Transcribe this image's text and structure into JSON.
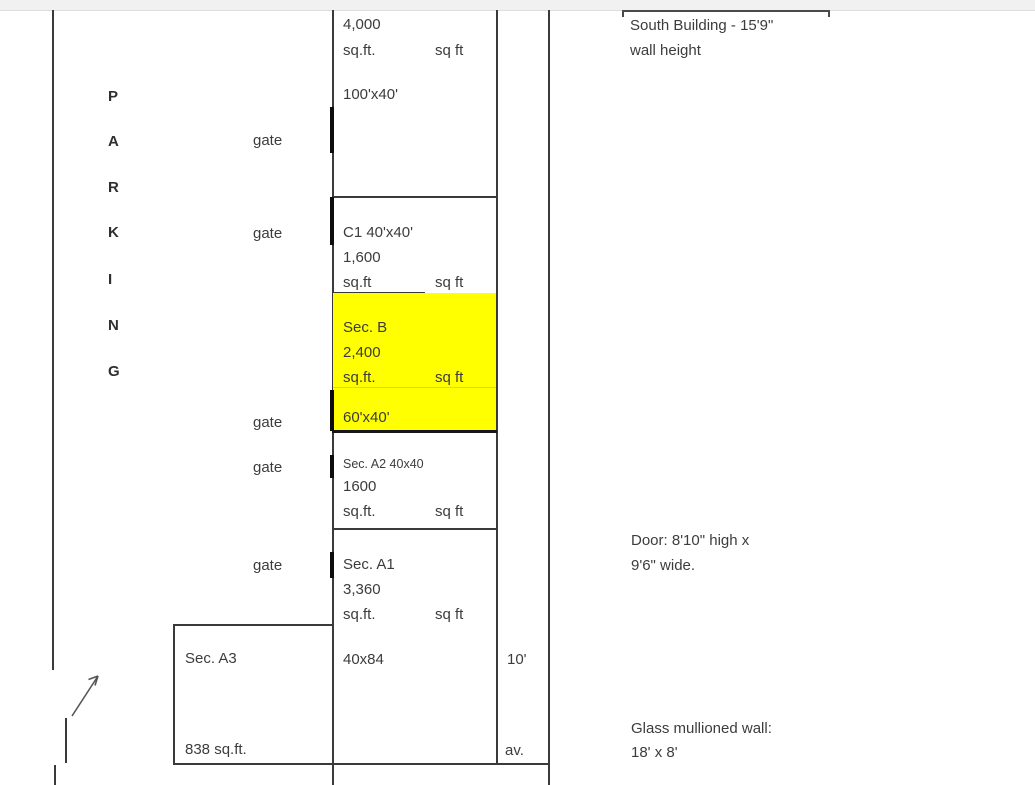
{
  "diagram": {
    "parking": {
      "letters": [
        "P",
        "A",
        "R",
        "K",
        "I",
        "N",
        "G"
      ]
    },
    "gate_label": "gate",
    "sections": {
      "north": {
        "area": "4,000",
        "unit_left": "sq.ft.",
        "unit_right": "sq ft",
        "dims": "100'x40'"
      },
      "c1": {
        "name": "C1 40'x40'",
        "area": "1,600",
        "unit_left": "sq.ft",
        "unit_right": "sq ft"
      },
      "b": {
        "name": "Sec. B",
        "area": "2,400",
        "unit_left": "sq.ft.",
        "unit_right": "sq ft",
        "dims": "60'x40'",
        "highlight_color": "#ffff00"
      },
      "a2": {
        "name": "Sec. A2 40x40",
        "area": "1600",
        "unit_left": "sq.ft.",
        "unit_right": "sq ft"
      },
      "a1": {
        "name": "Sec. A1",
        "area": "3,360",
        "unit_left": "sq.ft.",
        "unit_right": "sq ft",
        "dims": "40x84"
      },
      "a3": {
        "name": "Sec. A3",
        "area": "838 sq.ft."
      }
    },
    "avenue": {
      "width_label": "10'",
      "abbr": "av."
    },
    "annotations": {
      "south_building": {
        "line1": "South Building - 15'9\"",
        "line2": "wall height"
      },
      "door": {
        "line1": "Door: 8'10\" high x",
        "line2": "9'6\" wide."
      },
      "glass_wall": {
        "line1": "Glass mullioned wall:",
        "line2": "18' x 8'"
      }
    },
    "colors": {
      "highlight": "#ffff00",
      "line": "#3a3a3a",
      "text": "#3c3c3c"
    }
  }
}
